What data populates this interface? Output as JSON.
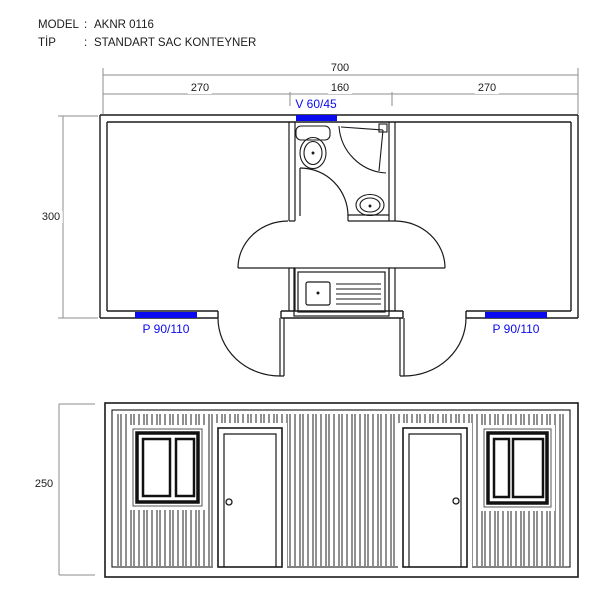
{
  "header": {
    "model_label": "MODEL",
    "tip_label": "TİP",
    "sep": ":",
    "model_value": "AKNR 0116",
    "tip_value": "STANDART SAC KONTEYNER"
  },
  "plan": {
    "dim_total": "700",
    "dim_seg_left": "270",
    "dim_seg_mid": "160",
    "dim_seg_right": "270",
    "dim_depth": "300",
    "top_window_label": "V 60/45",
    "bottom_left_window_label": "P 90/110",
    "bottom_right_window_label": "P 90/110"
  },
  "elevation": {
    "dim_height": "250"
  },
  "colors": {
    "accent_blue": "#0a0aef",
    "wall_line": "#1a1a1a",
    "dimension_line": "#8c8c8c"
  }
}
